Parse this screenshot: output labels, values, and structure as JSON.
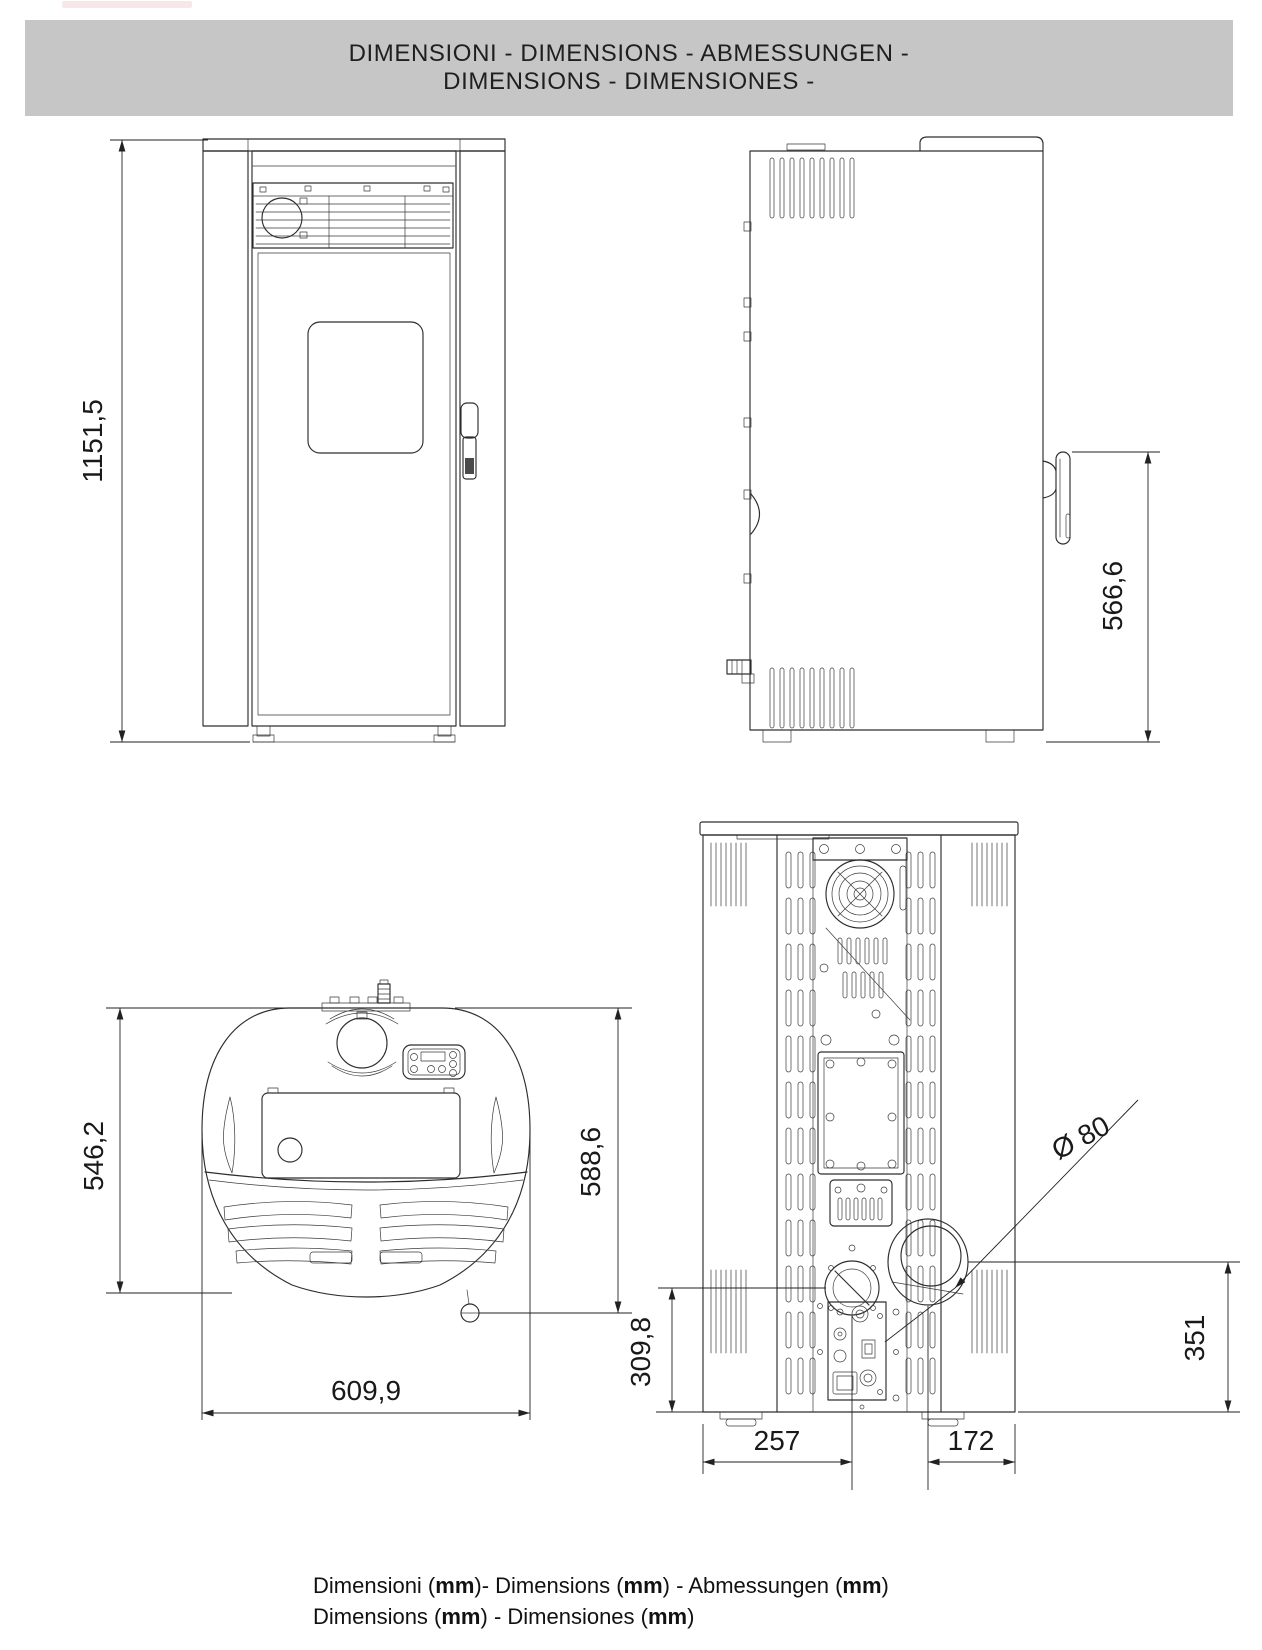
{
  "header": {
    "line1": "DIMENSIONI - DIMENSIONS - ABMESSUNGEN -",
    "line2": "DIMENSIONS - DIMENSIONES -"
  },
  "views": {
    "front": {
      "name": "front-view",
      "height": "1151,5"
    },
    "side": {
      "name": "side-view",
      "handle_height": "566,6"
    },
    "top": {
      "name": "top-view",
      "depth_left": "546,2",
      "depth_right": "588,6",
      "width": "609,9"
    },
    "rear": {
      "name": "rear-view",
      "flue_diameter": "Ø 80",
      "intake_height": "309,8",
      "flue_height": "351",
      "intake_offset_x": "257",
      "flue_offset_x": "172"
    }
  },
  "footer": {
    "lines": [
      [
        {
          "text": "Dimensioni (",
          "bold": false
        },
        {
          "text": "mm",
          "bold": true
        },
        {
          "text": ")- Dimensions (",
          "bold": false
        },
        {
          "text": "mm",
          "bold": true
        },
        {
          "text": ") - Abmessungen (",
          "bold": false
        },
        {
          "text": "mm",
          "bold": true
        },
        {
          "text": ")",
          "bold": false
        }
      ],
      [
        {
          "text": "Dimensions (",
          "bold": false
        },
        {
          "text": "mm",
          "bold": true
        },
        {
          "text": ") - Dimensiones (",
          "bold": false
        },
        {
          "text": "mm",
          "bold": true
        },
        {
          "text": ")",
          "bold": false
        }
      ]
    ]
  },
  "colors": {
    "header_bg": "#c5c6c5",
    "line": "#2d2d2d",
    "text": "#1a1a1a"
  }
}
